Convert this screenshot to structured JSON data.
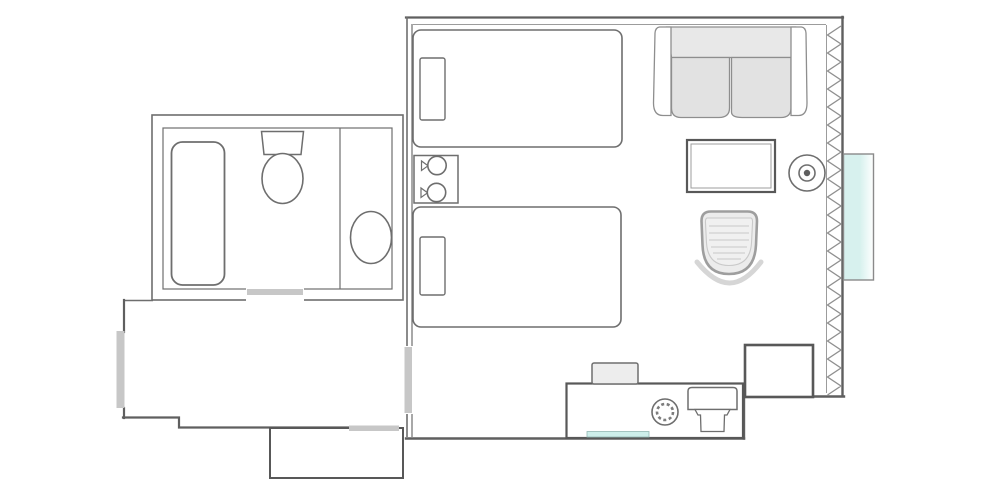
{
  "page": {
    "title": "Hotel room floor plan",
    "background": "#ffffff"
  },
  "colors": {
    "wall": "#5f5f5f",
    "outline": "#6e6e6e",
    "thin": "#9c9c9c",
    "opening": "#c7c7c7",
    "sofa-back": "#e8e8e8",
    "sofa-seat": "#e2e2e2",
    "chair-fill": "#ececec",
    "chair-stripe": "#d9d9d9",
    "halo": "#d6d6d6",
    "tray-fill": "#ededed",
    "glass": "#d7f1ee",
    "accent": "#cdeeea",
    "heavy": "#585858",
    "bg": "#ffffff"
  },
  "rooms": [
    {
      "id": "bathroom",
      "label": "Bathroom"
    },
    {
      "id": "entry-hall",
      "label": "Entry hall"
    },
    {
      "id": "main-room",
      "label": "Bedroom and sitting area"
    },
    {
      "id": "closet",
      "label": "Closet"
    }
  ],
  "openings": [
    {
      "id": "bathroom-door",
      "label": "Bathroom door opening"
    },
    {
      "id": "entry-door",
      "label": "Entry door"
    },
    {
      "id": "closet-door",
      "label": "Closet door opening"
    },
    {
      "id": "hall-doorway",
      "label": "Doorway from hall to main room"
    }
  ],
  "furniture": [
    {
      "id": "bathtub",
      "label": "Bathtub"
    },
    {
      "id": "toilet",
      "label": "Toilet"
    },
    {
      "id": "vanity-sink",
      "label": "Vanity sink"
    },
    {
      "id": "bed-1",
      "label": "Bed 1"
    },
    {
      "id": "bed-2",
      "label": "Bed 2"
    },
    {
      "id": "nightstand",
      "label": "Nightstand"
    },
    {
      "id": "bedside-lamps",
      "label": "Two bedside lamps"
    },
    {
      "id": "sofa",
      "label": "Loveseat sofa"
    },
    {
      "id": "table",
      "label": "Table"
    },
    {
      "id": "floor-lamp",
      "label": "Round floor lamp"
    },
    {
      "id": "armchair",
      "label": "Tub armchair"
    },
    {
      "id": "luggage-bench",
      "label": "Luggage bench"
    },
    {
      "id": "minibar-counter",
      "label": "Minibar counter"
    },
    {
      "id": "tray",
      "label": "Tray"
    },
    {
      "id": "burner",
      "label": "Round appliance"
    },
    {
      "id": "basin",
      "label": "Counter basin"
    },
    {
      "id": "window",
      "label": "Window"
    },
    {
      "id": "curtain",
      "label": "Curtain (zigzag)"
    }
  ]
}
